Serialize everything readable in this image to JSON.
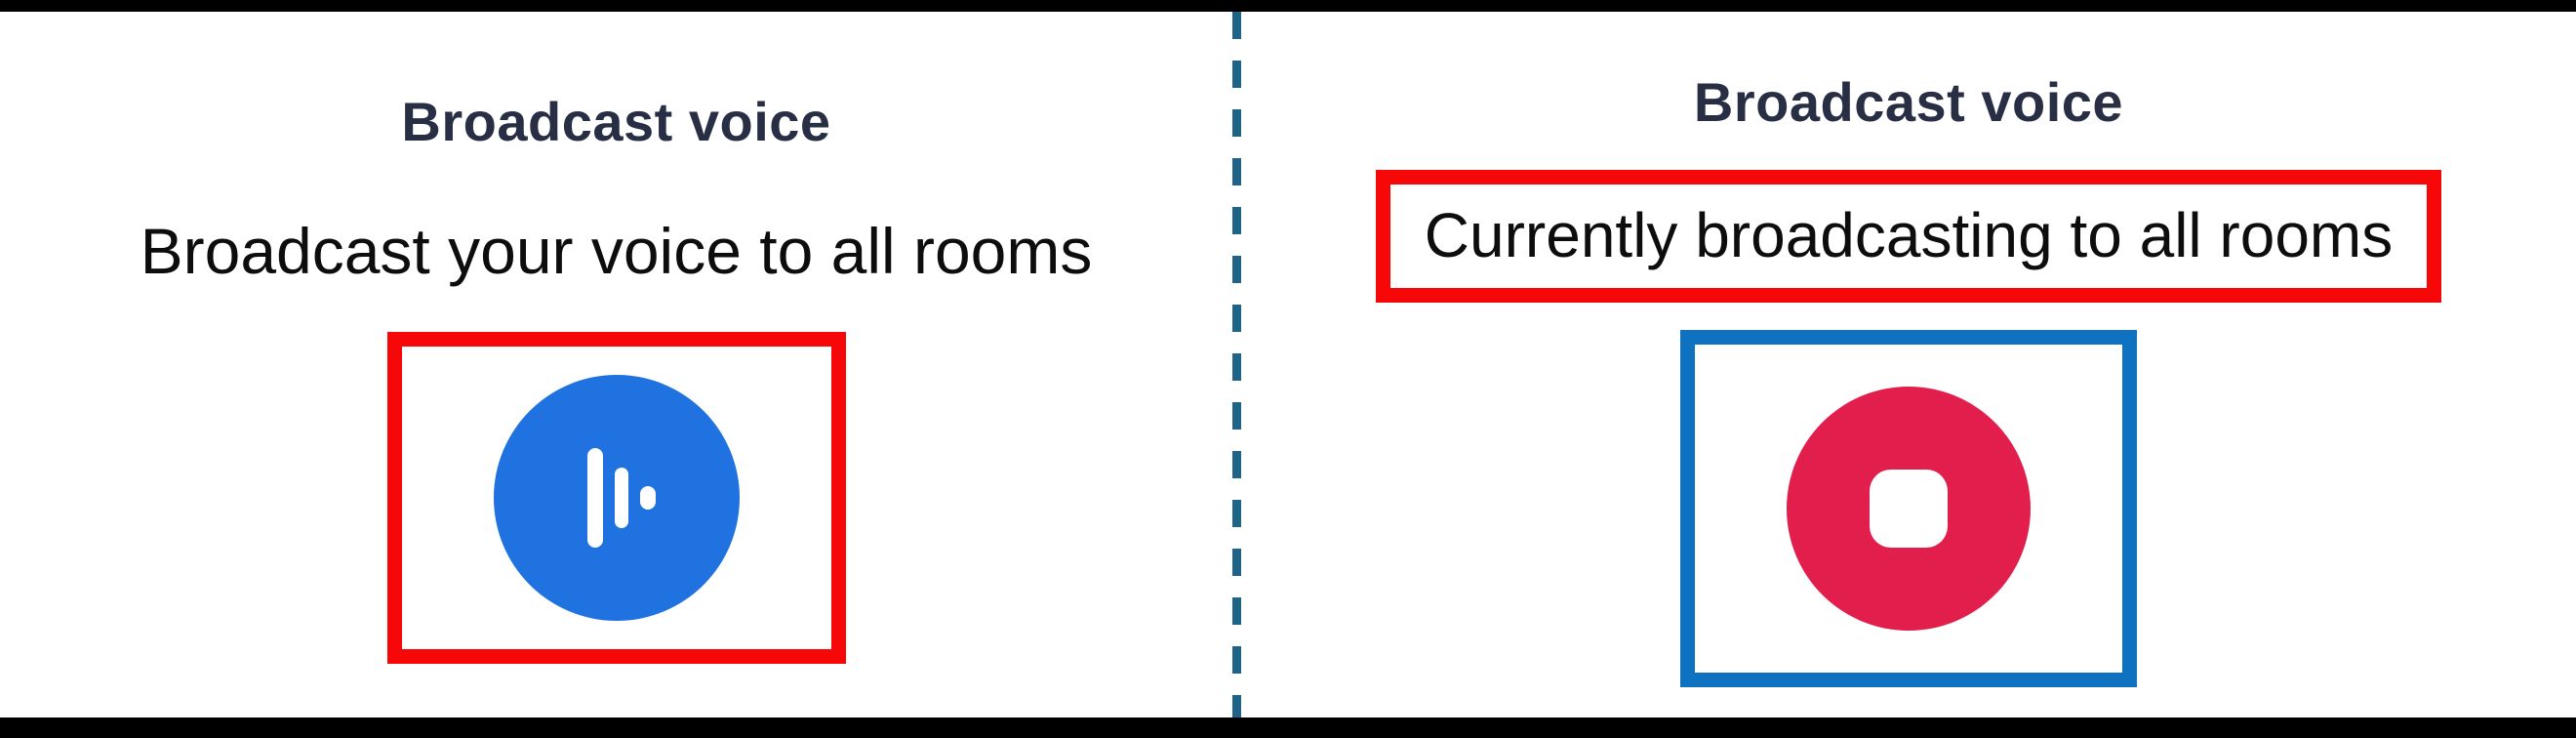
{
  "colors": {
    "page-bg": "#ffffff",
    "frame-bar": "#000000",
    "title-navy": "#282f44",
    "body-black": "#0d0d0d",
    "broadcast-blue": "#1f72e0",
    "stop-red": "#e21e4d",
    "icon-white": "#ffffff",
    "annotation-red": "#f60708",
    "annotation-blue": "#0e72c0",
    "divider-teal": "#1e6486"
  },
  "left_panel": {
    "title": "Broadcast voice",
    "subtitle": "Broadcast your voice to all rooms",
    "button": {
      "icon": "voice-wave-icon"
    }
  },
  "right_panel": {
    "title": "Broadcast voice",
    "status": "Currently broadcasting to all rooms",
    "button": {
      "icon": "stop-icon"
    }
  }
}
